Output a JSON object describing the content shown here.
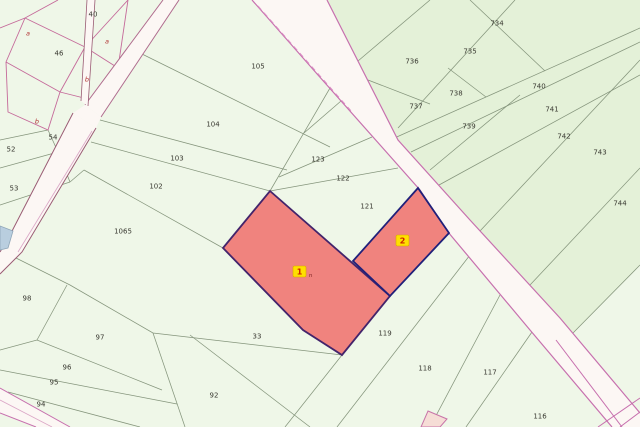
{
  "map": {
    "type": "cadastral-parcel-map",
    "region_fills": {
      "base": "#eff7e8",
      "northeast_block": "#e4f1d8",
      "road": "#fcf7f4",
      "small_pink_parcel": "#f6ddd6",
      "blue_patch": "#b9cedf"
    },
    "accent_colors": {
      "highlight_fill": "#f0837e",
      "highlight_border_1": "#43246b",
      "highlight_border_2": "#20207a",
      "road_edge_magenta": "#c770ae",
      "road_edge_maroon": "#9a5c74",
      "road_inner_pink": "#dba6c6",
      "pink_boundary": "#c56a9a",
      "parcel_line": "#85957c",
      "badge_fill": "#ffdf00",
      "badge_border": "#d8a800",
      "badge_text": "#cc2200",
      "letter_label": "#b03030",
      "label_text": "#3a3a32"
    },
    "badges": [
      {
        "label": "1",
        "suffix": "n",
        "x": 293,
        "y": 266
      },
      {
        "label": "2",
        "suffix": "",
        "x": 396,
        "y": 235
      }
    ],
    "parcel_labels": [
      {
        "t": "40",
        "x": 93,
        "y": 14
      },
      {
        "t": "46",
        "x": 59,
        "y": 53
      },
      {
        "t": "54",
        "x": 53,
        "y": 137
      },
      {
        "t": "52",
        "x": 11,
        "y": 149
      },
      {
        "t": "53",
        "x": 14,
        "y": 188
      },
      {
        "t": "105",
        "x": 258,
        "y": 66
      },
      {
        "t": "104",
        "x": 213,
        "y": 124
      },
      {
        "t": "103",
        "x": 177,
        "y": 158
      },
      {
        "t": "102",
        "x": 156,
        "y": 186
      },
      {
        "t": "1065",
        "x": 123,
        "y": 231
      },
      {
        "t": "98",
        "x": 27,
        "y": 298
      },
      {
        "t": "97",
        "x": 100,
        "y": 337
      },
      {
        "t": "96",
        "x": 67,
        "y": 367
      },
      {
        "t": "95",
        "x": 54,
        "y": 382
      },
      {
        "t": "94",
        "x": 41,
        "y": 404
      },
      {
        "t": "92",
        "x": 214,
        "y": 395
      },
      {
        "t": "33",
        "x": 257,
        "y": 336
      },
      {
        "t": "123",
        "x": 318,
        "y": 159
      },
      {
        "t": "122",
        "x": 343,
        "y": 178
      },
      {
        "t": "121",
        "x": 367,
        "y": 206
      },
      {
        "t": "119",
        "x": 385,
        "y": 333
      },
      {
        "t": "118",
        "x": 425,
        "y": 368
      },
      {
        "t": "117",
        "x": 490,
        "y": 372
      },
      {
        "t": "116",
        "x": 540,
        "y": 416
      },
      {
        "t": "734",
        "x": 497,
        "y": 23
      },
      {
        "t": "735",
        "x": 470,
        "y": 51
      },
      {
        "t": "736",
        "x": 412,
        "y": 61
      },
      {
        "t": "737",
        "x": 416,
        "y": 106
      },
      {
        "t": "738",
        "x": 456,
        "y": 93
      },
      {
        "t": "739",
        "x": 469,
        "y": 126
      },
      {
        "t": "740",
        "x": 539,
        "y": 86
      },
      {
        "t": "741",
        "x": 552,
        "y": 109
      },
      {
        "t": "742",
        "x": 564,
        "y": 136
      },
      {
        "t": "743",
        "x": 600,
        "y": 152
      },
      {
        "t": "744",
        "x": 620,
        "y": 203
      }
    ],
    "letter_labels": [
      {
        "t": "a",
        "x": 28,
        "y": 33
      },
      {
        "t": "a",
        "x": 107,
        "y": 41
      },
      {
        "t": "b",
        "x": 87,
        "y": 79
      },
      {
        "t": "b",
        "x": 37,
        "y": 121
      }
    ]
  }
}
